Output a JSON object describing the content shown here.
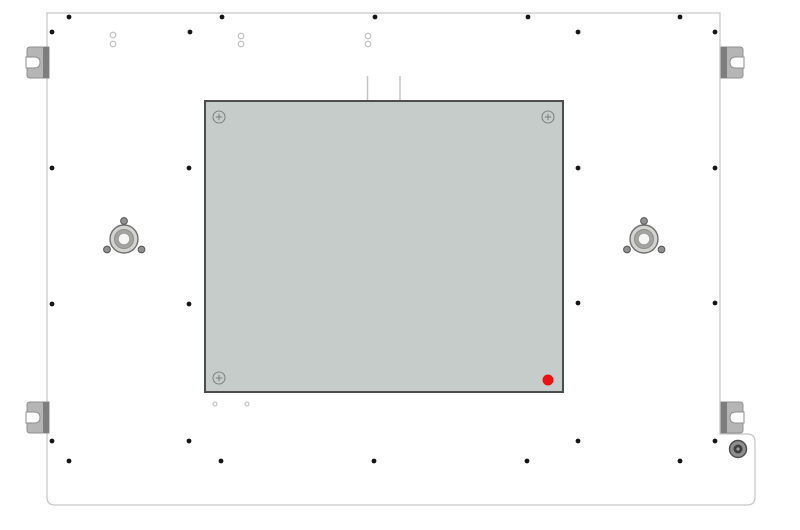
{
  "canvas": {
    "width": 800,
    "height": 530,
    "background": "#ffffff"
  },
  "drawing": {
    "panel": {
      "x": 47,
      "y": 13,
      "right": 720,
      "bottom": 505,
      "step_y": 434,
      "ext_right": 755,
      "corner_radius": 8,
      "fill": "#ffffff",
      "outline_color": "#c8c8c8",
      "outline_width": 1.3
    },
    "plate": {
      "x": 205,
      "y": 101,
      "width": 358,
      "height": 291,
      "fill": "#c5ccc9",
      "border_color": "#4d4d4d",
      "border_width": 2
    },
    "screws": {
      "style": {
        "r": 6,
        "color": "#7d8683",
        "cross_half": 3.2,
        "stroke_width": 1.1
      },
      "items": [
        {
          "cx": 219,
          "cy": 117
        },
        {
          "cx": 548,
          "cy": 117
        },
        {
          "cx": 219,
          "cy": 378
        }
      ]
    },
    "red_dot": {
      "cx": 548,
      "cy": 380,
      "r": 5.5,
      "color": "#ee1111"
    },
    "connector_lines": {
      "color": "#c4c4c4",
      "width": 1.5,
      "items": [
        {
          "x": 367.5,
          "y1": 76,
          "y2": 102
        },
        {
          "x": 400,
          "y1": 76,
          "y2": 102
        }
      ]
    },
    "black_dots": {
      "r": 2.4,
      "color": "#161616",
      "points": [
        [
          69,
          17
        ],
        [
          222,
          17
        ],
        [
          375,
          17
        ],
        [
          528,
          17
        ],
        [
          680,
          17
        ],
        [
          52,
          32
        ],
        [
          190,
          32
        ],
        [
          578,
          32
        ],
        [
          715,
          32
        ],
        [
          52,
          168
        ],
        [
          189,
          168
        ],
        [
          578,
          168
        ],
        [
          715,
          168
        ],
        [
          52,
          304
        ],
        [
          189,
          304
        ],
        [
          578,
          303
        ],
        [
          715,
          303
        ],
        [
          52,
          441
        ],
        [
          189,
          441
        ],
        [
          578,
          441
        ],
        [
          715,
          441
        ],
        [
          69,
          461
        ],
        [
          221,
          461
        ],
        [
          374,
          461
        ],
        [
          527,
          461
        ],
        [
          680,
          461
        ]
      ]
    },
    "open_circles": {
      "stroke": "#bdbdbd",
      "stroke_width": 1.1,
      "fill": "#ffffff",
      "items": [
        {
          "cx": 113,
          "cy": 35,
          "r": 2.8
        },
        {
          "cx": 113,
          "cy": 44,
          "r": 2.8
        },
        {
          "cx": 241,
          "cy": 36,
          "r": 2.8
        },
        {
          "cx": 241,
          "cy": 44,
          "r": 2.8
        },
        {
          "cx": 368,
          "cy": 36,
          "r": 2.8
        },
        {
          "cx": 368,
          "cy": 44,
          "r": 2.8
        },
        {
          "cx": 215,
          "cy": 404,
          "r": 2.0
        },
        {
          "cx": 247,
          "cy": 404,
          "r": 2.0
        }
      ]
    },
    "brackets": {
      "style": {
        "width": 22,
        "height": 31,
        "body": "#b5b5b5",
        "edge": "#7d7d7d",
        "outline": "#8f8f8f",
        "notch_depth": 13,
        "notch_height": 11,
        "strip_width": 6
      },
      "items": [
        {
          "x": 27,
          "y": 47,
          "side": "left"
        },
        {
          "x": 27,
          "y": 402,
          "side": "left"
        },
        {
          "x": 721,
          "y": 47,
          "side": "right"
        },
        {
          "x": 721,
          "y": 402,
          "side": "right"
        }
      ]
    },
    "bushings": {
      "centers": [
        [
          124,
          239
        ],
        [
          644,
          239
        ]
      ],
      "outer": {
        "r": 14,
        "fill": "#d3d3d0",
        "stroke": "#707070",
        "stroke_width": 1.4
      },
      "mid": {
        "r": 9.5,
        "fill": "#a4a49f",
        "stroke": "#8d8d8d",
        "stroke_width": 1
      },
      "hole": {
        "r": 5.8,
        "fill": "#f5f5f3",
        "stroke": "#9c9c9c",
        "stroke_width": 1
      },
      "satellite": {
        "r": 3.4,
        "fill": "#909090",
        "stroke": "#565656",
        "stroke_width": 1
      },
      "satellite_offsets": [
        [
          0,
          -18
        ],
        [
          -17,
          10.5
        ],
        [
          17.5,
          10.5
        ]
      ]
    },
    "grommet": {
      "cx": 738,
      "cy": 449,
      "outer": {
        "r": 8.5,
        "fill": "#8e8e8e",
        "stroke": "#4c4c4c",
        "stroke_width": 1.4
      },
      "mid": {
        "r": 4.5,
        "fill": "#3e3e3e"
      },
      "center": {
        "r": 1.6,
        "fill": "#9e9e9e"
      }
    }
  }
}
